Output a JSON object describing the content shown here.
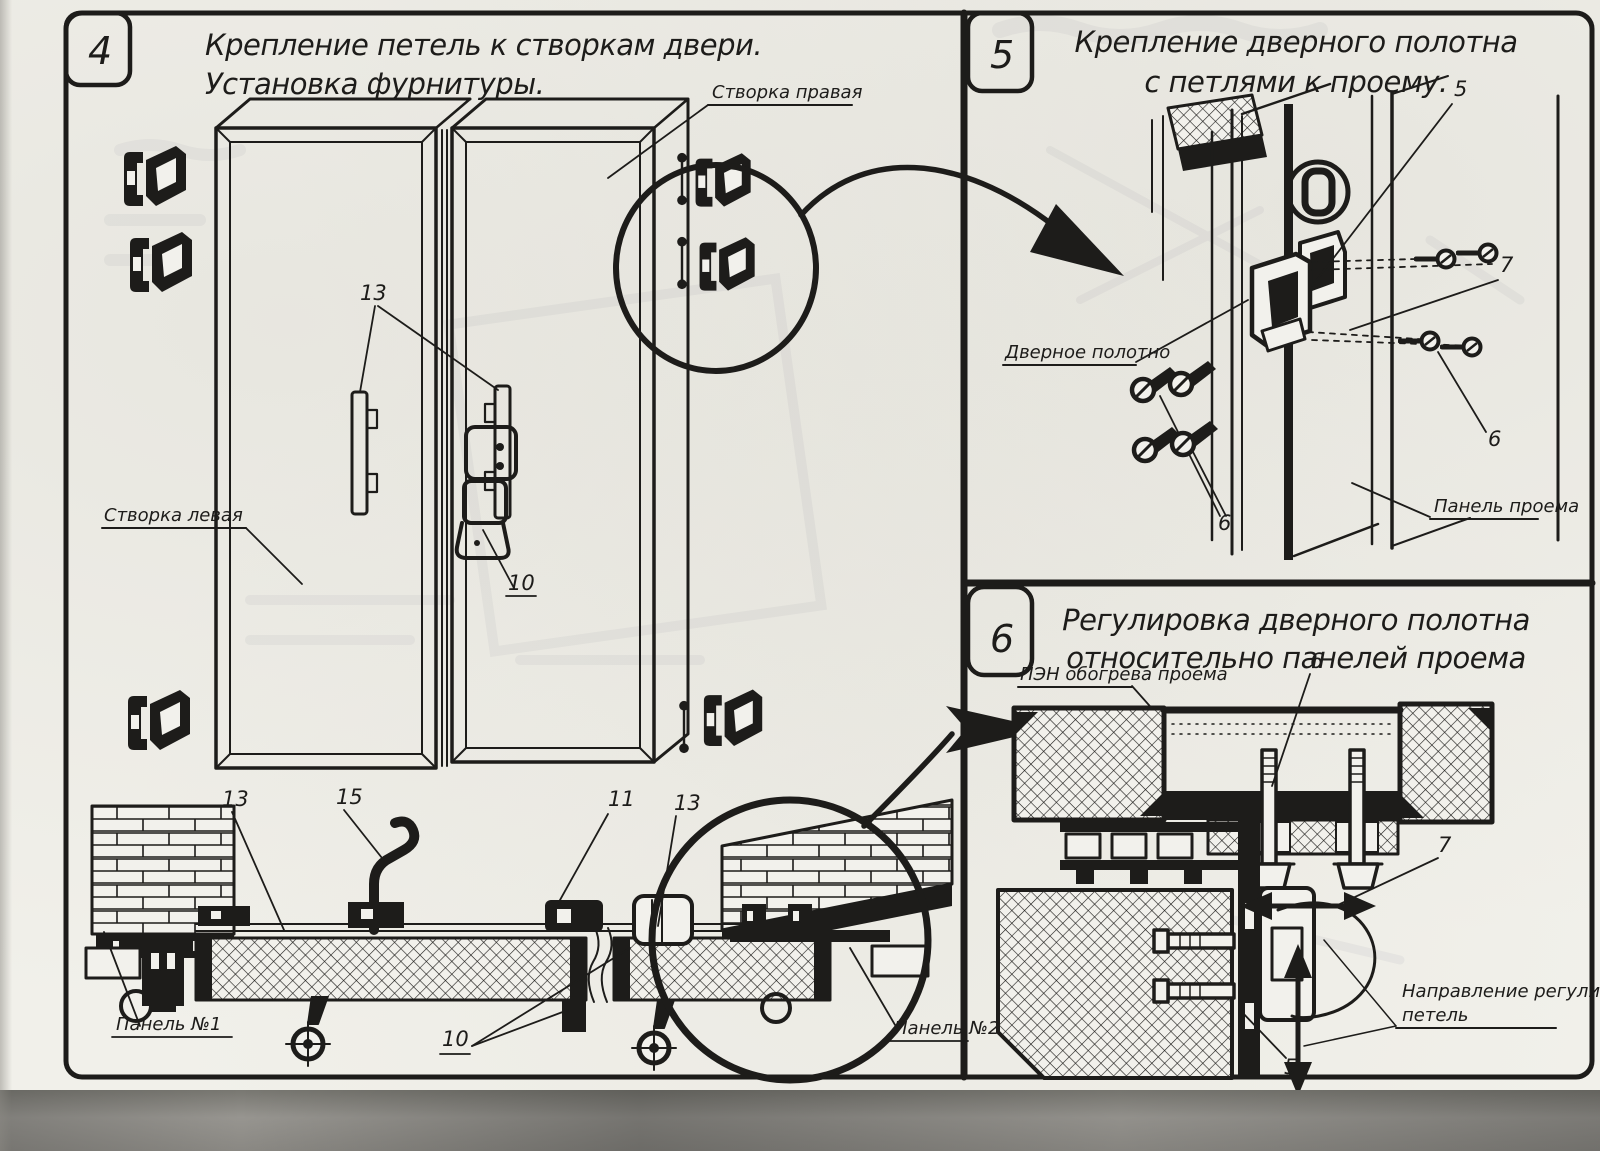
{
  "page": {
    "panel4": {
      "number": "4",
      "title1": "Крепление петель к створкам двери.",
      "title2": "Установка фурнитуры.",
      "label_right_leaf": "Створка правая",
      "label_left_leaf": "Створка левая",
      "label_panel1": "Панель №1",
      "label_panel2": "Панель №2",
      "co_hinge_plates": "13",
      "co_lock": "10",
      "co_sec_left_hinge": "13",
      "co_handle": "15",
      "co_sec_lock": "11",
      "co_sec_right_hinge": "13",
      "co_sec_lock_bottom": "10"
    },
    "panel5": {
      "number": "5",
      "title1": "Крепление дверного полотна",
      "title2": "с петлями к проему.",
      "label_door_leaf": "Дверное полотно",
      "label_opening_panel": "Панель проема",
      "co_hinge": "5",
      "co_bracket": "7",
      "co_screws_right": "6",
      "co_screws_left": "6"
    },
    "panel6": {
      "number": "6",
      "title1": "Регулировка дверного полотна",
      "title2": "относительно панелей проема",
      "label_heater": "ПЭН обогрева проема",
      "label_dir1": "Направление регулировки",
      "label_dir2": "петель",
      "co_bolt": "6",
      "co_hinge_side": "7",
      "co_hinge_bottom": "5"
    }
  }
}
